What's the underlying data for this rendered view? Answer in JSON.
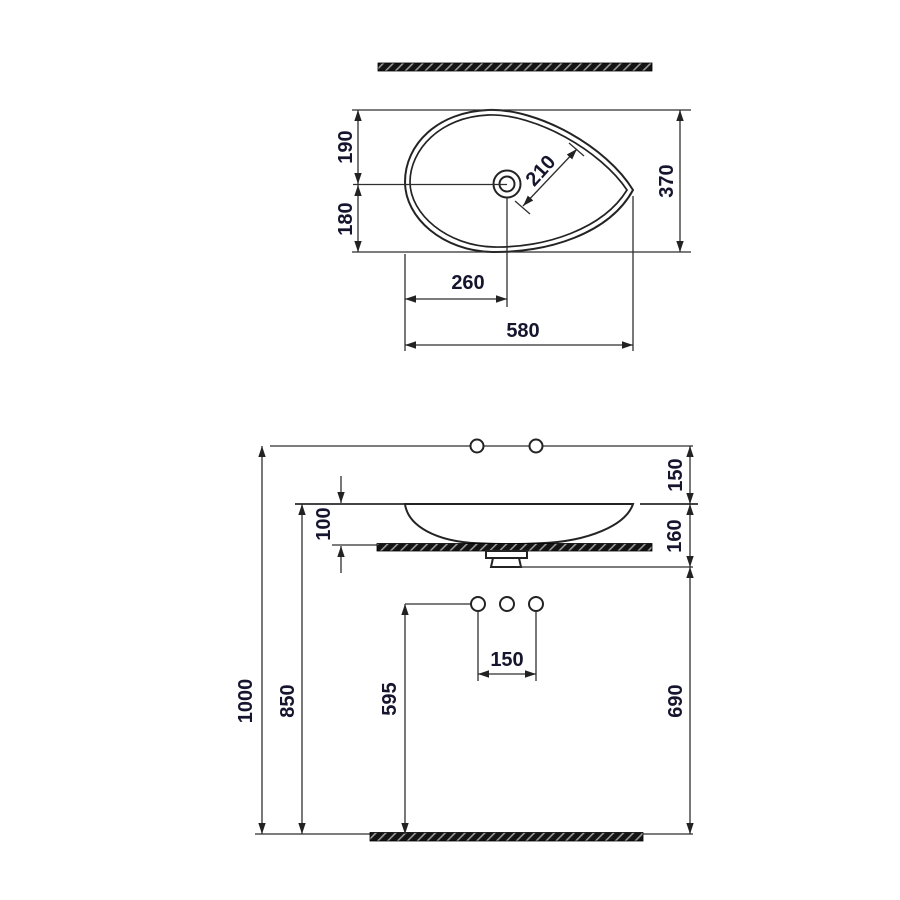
{
  "drawing": {
    "kind": "sink-dimension-drawing",
    "colors": {
      "background": "#ffffff",
      "line": "#2a2a2a",
      "label": "#15152e",
      "section_fill": "#111111"
    }
  },
  "top_view": {
    "dims": {
      "depth_upper": "190",
      "depth_lower": "180",
      "drain_diagonal": "210",
      "depth_total": "370",
      "drain_offset": "260",
      "width_total": "580"
    }
  },
  "front_view": {
    "dims": {
      "faucet_above_rim": "150",
      "basin_height": "100",
      "rim_to_underside": "160",
      "total_height": "1000",
      "counter_height": "850",
      "outlet_height": "595",
      "hole_spacing": "150",
      "under_counter": "690"
    }
  }
}
